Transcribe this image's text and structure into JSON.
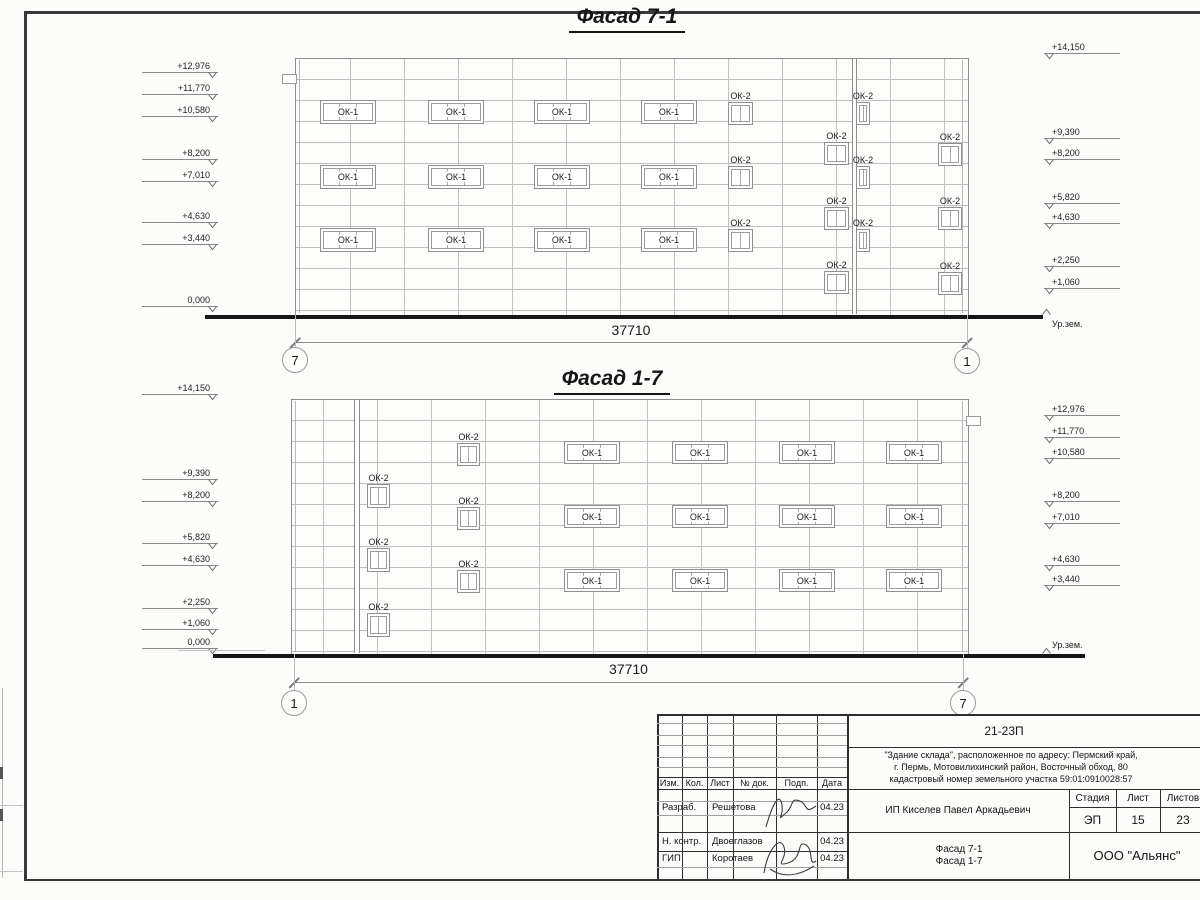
{
  "colors": {
    "ink": "#1b1b1b",
    "grid_line": "#bdbdbd",
    "outline": "#8d8d8d",
    "ground": "#161616",
    "stamp_line": "#2e2e2e"
  },
  "facades": [
    {
      "title": {
        "text": "Фасад 7-1",
        "cx": 627,
        "y": 5
      },
      "body": {
        "x": 295,
        "y": 58,
        "w": 672,
        "h": 257
      },
      "grid": {
        "ox": 1
      },
      "pilasters": [
        {
          "x": 852,
          "w": 5
        }
      ],
      "notch": {
        "x": 282,
        "y": 74,
        "w": 13,
        "h": 8
      },
      "windows": [
        {
          "label": "ОК-1",
          "x": 320,
          "y": 100,
          "w": 56,
          "h": 24,
          "panes": 3,
          "lp": "in"
        },
        {
          "label": "ОК-1",
          "x": 428,
          "y": 100,
          "w": 56,
          "h": 24,
          "panes": 3,
          "lp": "in"
        },
        {
          "label": "ОК-1",
          "x": 534,
          "y": 100,
          "w": 56,
          "h": 24,
          "panes": 3,
          "lp": "in"
        },
        {
          "label": "ОК-1",
          "x": 641,
          "y": 100,
          "w": 56,
          "h": 24,
          "panes": 3,
          "lp": "in"
        },
        {
          "label": "ОК-1",
          "x": 320,
          "y": 165,
          "w": 56,
          "h": 24,
          "panes": 3,
          "lp": "in"
        },
        {
          "label": "ОК-1",
          "x": 428,
          "y": 165,
          "w": 56,
          "h": 24,
          "panes": 3,
          "lp": "in"
        },
        {
          "label": "ОК-1",
          "x": 534,
          "y": 165,
          "w": 56,
          "h": 24,
          "panes": 3,
          "lp": "in"
        },
        {
          "label": "ОК-1",
          "x": 641,
          "y": 165,
          "w": 56,
          "h": 24,
          "panes": 3,
          "lp": "in"
        },
        {
          "label": "ОК-1",
          "x": 320,
          "y": 228,
          "w": 56,
          "h": 24,
          "panes": 3,
          "lp": "in"
        },
        {
          "label": "ОК-1",
          "x": 428,
          "y": 228,
          "w": 56,
          "h": 24,
          "panes": 3,
          "lp": "in"
        },
        {
          "label": "ОК-1",
          "x": 534,
          "y": 228,
          "w": 56,
          "h": 24,
          "panes": 3,
          "lp": "in"
        },
        {
          "label": "ОК-1",
          "x": 641,
          "y": 228,
          "w": 56,
          "h": 24,
          "panes": 3,
          "lp": "in"
        },
        {
          "label": "ОК-2",
          "x": 728,
          "y": 102,
          "w": 25,
          "h": 23,
          "panes": 2,
          "lp": "above"
        },
        {
          "label": "ОК-2",
          "x": 728,
          "y": 166,
          "w": 25,
          "h": 23,
          "panes": 2,
          "lp": "above"
        },
        {
          "label": "ОК-2",
          "x": 728,
          "y": 229,
          "w": 25,
          "h": 23,
          "panes": 2,
          "lp": "above"
        },
        {
          "label": "ОК-2",
          "x": 824,
          "y": 142,
          "w": 25,
          "h": 23,
          "panes": 2,
          "lp": "above"
        },
        {
          "label": "ОК-2",
          "x": 824,
          "y": 207,
          "w": 25,
          "h": 23,
          "panes": 2,
          "lp": "above"
        },
        {
          "label": "ОК-2",
          "x": 824,
          "y": 271,
          "w": 25,
          "h": 23,
          "panes": 2,
          "lp": "above"
        },
        {
          "label": "ОК-2",
          "x": 856,
          "y": 102,
          "w": 14,
          "h": 23,
          "panes": 2,
          "lp": "above"
        },
        {
          "label": "ОК-2",
          "x": 856,
          "y": 166,
          "w": 14,
          "h": 23,
          "panes": 2,
          "lp": "above"
        },
        {
          "label": "ОК-2",
          "x": 856,
          "y": 229,
          "w": 14,
          "h": 23,
          "panes": 2,
          "lp": "above"
        },
        {
          "label": "ОК-2",
          "x": 938,
          "y": 143,
          "w": 24,
          "h": 23,
          "panes": 2,
          "lp": "above"
        },
        {
          "label": "ОК-2",
          "x": 938,
          "y": 207,
          "w": 24,
          "h": 23,
          "panes": 2,
          "lp": "above"
        },
        {
          "label": "ОК-2",
          "x": 938,
          "y": 272,
          "w": 24,
          "h": 23,
          "panes": 2,
          "lp": "above"
        }
      ],
      "marks_left": {
        "x": 218,
        "items": [
          {
            "t": "+12,976",
            "y": 73
          },
          {
            "t": "+11,770",
            "y": 95
          },
          {
            "t": "+10,580",
            "y": 117
          },
          {
            "t": "+8,200",
            "y": 160
          },
          {
            "t": "+7,010",
            "y": 182
          },
          {
            "t": "+4,630",
            "y": 223
          },
          {
            "t": "+3,440",
            "y": 245
          },
          {
            "t": "0,000",
            "y": 307
          }
        ]
      },
      "marks_right": {
        "x": 1044,
        "items": [
          {
            "t": "+14,150",
            "y": 54
          },
          {
            "t": "+9,390",
            "y": 139
          },
          {
            "t": "+8,200",
            "y": 160
          },
          {
            "t": "+5,820",
            "y": 204
          },
          {
            "t": "+4,630",
            "y": 224
          },
          {
            "t": "+2,250",
            "y": 267
          },
          {
            "t": "+1,060",
            "y": 289
          }
        ]
      },
      "ground": {
        "x1": 205,
        "x2": 1043,
        "y": 315,
        "label": "Ур.зем.",
        "label_x": 1052,
        "label_y": 319,
        "chev_x": 1042,
        "chev_y": 309,
        "sub": null
      },
      "dim": {
        "y": 342,
        "x1": 295,
        "x2": 967,
        "text": "37710",
        "ty": 322
      },
      "bubbles": [
        {
          "t": "7",
          "cx": 295,
          "cy": 360
        },
        {
          "t": "1",
          "cx": 967,
          "cy": 361
        }
      ]
    },
    {
      "title": {
        "text": "Фасад 1-7",
        "cx": 612,
        "y": 367
      },
      "body": {
        "x": 291,
        "y": 399,
        "w": 676,
        "h": 255
      },
      "grid": {
        "ox": -22
      },
      "pilasters": [
        {
          "x": 354,
          "w": 6
        }
      ],
      "notch": {
        "x": 966,
        "y": 416,
        "w": 13,
        "h": 8
      },
      "windows": [
        {
          "label": "ОК-2",
          "x": 367,
          "y": 484,
          "w": 23,
          "h": 24,
          "panes": 2,
          "lp": "above"
        },
        {
          "label": "ОК-2",
          "x": 367,
          "y": 548,
          "w": 23,
          "h": 24,
          "panes": 2,
          "lp": "above"
        },
        {
          "label": "ОК-2",
          "x": 367,
          "y": 613,
          "w": 23,
          "h": 24,
          "panes": 2,
          "lp": "above"
        },
        {
          "label": "ОК-2",
          "x": 457,
          "y": 443,
          "w": 23,
          "h": 23,
          "panes": 2,
          "lp": "above"
        },
        {
          "label": "ОК-2",
          "x": 457,
          "y": 507,
          "w": 23,
          "h": 23,
          "panes": 2,
          "lp": "above"
        },
        {
          "label": "ОК-2",
          "x": 457,
          "y": 570,
          "w": 23,
          "h": 23,
          "panes": 2,
          "lp": "above"
        },
        {
          "label": "ОК-1",
          "x": 564,
          "y": 441,
          "w": 56,
          "h": 23,
          "panes": 3,
          "lp": "in"
        },
        {
          "label": "ОК-1",
          "x": 672,
          "y": 441,
          "w": 56,
          "h": 23,
          "panes": 3,
          "lp": "in"
        },
        {
          "label": "ОК-1",
          "x": 779,
          "y": 441,
          "w": 56,
          "h": 23,
          "panes": 3,
          "lp": "in"
        },
        {
          "label": "ОК-1",
          "x": 886,
          "y": 441,
          "w": 56,
          "h": 23,
          "panes": 3,
          "lp": "in"
        },
        {
          "label": "ОК-1",
          "x": 564,
          "y": 505,
          "w": 56,
          "h": 23,
          "panes": 3,
          "lp": "in"
        },
        {
          "label": "ОК-1",
          "x": 672,
          "y": 505,
          "w": 56,
          "h": 23,
          "panes": 3,
          "lp": "in"
        },
        {
          "label": "ОК-1",
          "x": 779,
          "y": 505,
          "w": 56,
          "h": 23,
          "panes": 3,
          "lp": "in"
        },
        {
          "label": "ОК-1",
          "x": 886,
          "y": 505,
          "w": 56,
          "h": 23,
          "panes": 3,
          "lp": "in"
        },
        {
          "label": "ОК-1",
          "x": 564,
          "y": 569,
          "w": 56,
          "h": 23,
          "panes": 3,
          "lp": "in"
        },
        {
          "label": "ОК-1",
          "x": 672,
          "y": 569,
          "w": 56,
          "h": 23,
          "panes": 3,
          "lp": "in"
        },
        {
          "label": "ОК-1",
          "x": 779,
          "y": 569,
          "w": 56,
          "h": 23,
          "panes": 3,
          "lp": "in"
        },
        {
          "label": "ОК-1",
          "x": 886,
          "y": 569,
          "w": 56,
          "h": 23,
          "panes": 3,
          "lp": "in"
        }
      ],
      "marks_left": {
        "x": 218,
        "items": [
          {
            "t": "+14,150",
            "y": 395
          },
          {
            "t": "+9,390",
            "y": 480
          },
          {
            "t": "+8,200",
            "y": 502
          },
          {
            "t": "+5,820",
            "y": 544
          },
          {
            "t": "+4,630",
            "y": 566
          },
          {
            "t": "+2,250",
            "y": 609
          },
          {
            "t": "+1,060",
            "y": 630
          },
          {
            "t": "0,000",
            "y": 649
          }
        ]
      },
      "marks_right": {
        "x": 1044,
        "items": [
          {
            "t": "+12,976",
            "y": 416
          },
          {
            "t": "+11,770",
            "y": 438
          },
          {
            "t": "+10,580",
            "y": 459
          },
          {
            "t": "+8,200",
            "y": 502
          },
          {
            "t": "+7,010",
            "y": 524
          },
          {
            "t": "+4,630",
            "y": 566
          },
          {
            "t": "+3,440",
            "y": 586
          }
        ]
      },
      "ground": {
        "x1": 213,
        "x2": 1085,
        "y": 654,
        "label": "Ур.зем.",
        "label_x": 1052,
        "label_y": 640,
        "chev_x": 1042,
        "chev_y": 648,
        "sub": {
          "x1": 178,
          "x2": 265,
          "y": 650
        }
      },
      "dim": {
        "y": 682,
        "x1": 294,
        "x2": 963,
        "text": "37710",
        "ty": 661
      },
      "bubbles": [
        {
          "t": "1",
          "cx": 294,
          "cy": 703
        },
        {
          "t": "7",
          "cx": 963,
          "cy": 703
        }
      ]
    }
  ],
  "title_block": {
    "code": "21-23П",
    "address1": "\"Здание склада\", расположенное по адресу: Пермский край,",
    "address2": "г. Пермь, Мотовилихинский район, Восточный обход, 80",
    "address3": "кадастровый номер земельного участка 59:01:0910028:57",
    "cols": {
      "izm": "Изм.",
      "kol": "Кол.",
      "list": "Лист",
      "ndok": "№ док.",
      "podp": "Подп.",
      "data": "Дата"
    },
    "rows": [
      {
        "role": "Разраб.",
        "name": "Решетова",
        "date": "04.23"
      },
      {
        "role": "Н. контр.",
        "name": "Двоеглазов",
        "date": "04.23"
      },
      {
        "role": "ГИП",
        "name": "Коротаев",
        "date": "04.23"
      }
    ],
    "client": "ИП Киселев Павел Аркадьевич",
    "stage_h": "Стадия",
    "list_h": "Лист",
    "listov_h": "Листов",
    "stage": "ЭП",
    "list_no": "15",
    "listov": "23",
    "subject1": "Фасад 7-1",
    "subject2": "Фасад 1-7",
    "company": "ООО \"Альянс\""
  }
}
